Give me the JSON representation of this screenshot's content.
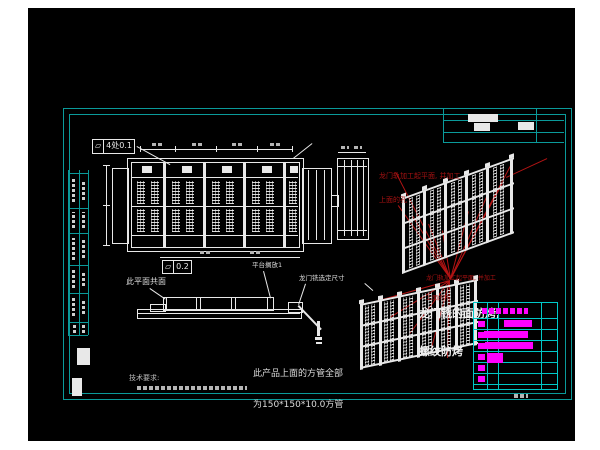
{
  "colors": {
    "white": "#e8e8e8",
    "gray": "#b5b5b5",
    "frame": "#0a9a9a",
    "table": "#00c8c8",
    "magenta": "#ff00ff",
    "red": "#b41414"
  },
  "annotations": {
    "fcf1_symbol": "▱",
    "fcf1_value": "4处0.1",
    "fcf2_symbol": "▱",
    "fcf2_value": "0.2",
    "coplanar_label": "此平面共面",
    "platform_label": "平台搁放1",
    "mill_dim_label": "龙门铣选定尺寸",
    "red_note_top_line1": "龙门轨加工起平面, 并加工",
    "red_note_top_line2": "上面的孔",
    "red_note_bottom_line1": "龙门轨加工起平面, 并加工",
    "red_note_bottom_line2": "上面的孔",
    "white_note_line1": "龙门铣的面防烤,",
    "white_note_line2": "螺纹防烤",
    "tube_note_line1": "此产品上面的方管全部",
    "tube_note_line2": "为150*150*10.0方管",
    "tech_req_title": "技术要求:"
  },
  "bom": {
    "box": [
      473,
      302,
      83,
      86
    ],
    "cols": [
      13,
      24,
      67
    ],
    "header_h": 15,
    "row_h": 11,
    "row_count": 6,
    "header_mask": [
      8,
      5,
      46,
      6
    ],
    "tag_blocks_y": [
      18,
      29,
      40,
      51,
      62,
      73
    ],
    "bars": [
      [
        30,
        17,
        28,
        7
      ],
      [
        10,
        28,
        44,
        7
      ],
      [
        11,
        39,
        48,
        7
      ],
      [
        13,
        50,
        16,
        10
      ]
    ]
  },
  "drawing": {
    "canvas": [
      28,
      8,
      547,
      433
    ],
    "frame_outer": [
      63,
      108,
      507,
      290
    ],
    "frame_inner": [
      69,
      114,
      495,
      278
    ],
    "left_strip": {
      "vlines": [
        [
          68,
          170,
          165
        ],
        [
          79,
          170,
          165
        ],
        [
          88,
          170,
          165
        ]
      ],
      "hlines": [
        [
          68,
          173,
          20
        ],
        [
          68,
          208,
          20
        ],
        [
          68,
          233,
          20
        ],
        [
          68,
          265,
          20
        ],
        [
          68,
          293,
          20
        ],
        [
          68,
          322,
          20
        ],
        [
          68,
          335,
          20
        ]
      ]
    },
    "corner": {
      "hlines": [
        [
          443,
          120,
          121
        ],
        [
          443,
          132,
          121
        ],
        [
          443,
          142,
          121
        ]
      ],
      "vlines": [
        [
          536,
          108,
          34
        ],
        [
          443,
          108,
          34
        ]
      ]
    },
    "fills": [
      [
        77,
        348,
        13,
        17
      ],
      [
        72,
        378,
        10,
        18
      ],
      [
        468,
        114,
        30,
        8
      ],
      [
        474,
        123,
        16,
        8
      ],
      [
        518,
        122,
        16,
        8
      ],
      [
        163,
        162,
        3,
        86
      ],
      [
        203,
        162,
        3,
        86
      ],
      [
        243,
        162,
        3,
        86
      ],
      [
        283,
        162,
        3,
        86
      ],
      [
        142,
        166,
        10,
        7
      ],
      [
        182,
        166,
        10,
        7
      ],
      [
        222,
        166,
        10,
        7
      ],
      [
        262,
        166,
        10,
        7
      ],
      [
        290,
        166,
        8,
        7
      ],
      [
        317,
        321,
        3,
        15
      ],
      [
        315,
        337,
        7,
        3
      ],
      [
        316,
        342,
        6,
        2
      ]
    ],
    "rects": [
      [
        127,
        158,
        175,
        92
      ],
      [
        131,
        162,
        167,
        84
      ],
      [
        112,
        168,
        15,
        74
      ],
      [
        302,
        168,
        28,
        74
      ],
      [
        337,
        158,
        30,
        80
      ],
      [
        331,
        195,
        6,
        10
      ],
      [
        137,
        309,
        163,
        8
      ],
      [
        150,
        304,
        14,
        6
      ],
      [
        163,
        297,
        109,
        12
      ],
      [
        288,
        302,
        13,
        9
      ]
    ],
    "hl_w": [
      [
        131,
        177,
        167
      ],
      [
        131,
        206,
        167
      ],
      [
        131,
        235,
        167
      ],
      [
        337,
        166,
        30
      ],
      [
        337,
        230,
        30
      ],
      [
        338,
        152,
        28
      ],
      [
        137,
        313,
        163
      ],
      [
        140,
        149,
        152
      ],
      [
        160,
        257,
        140
      ],
      [
        103,
        165,
        7
      ],
      [
        103,
        205,
        7
      ],
      [
        103,
        245,
        7
      ]
    ],
    "vl_w": [
      [
        344,
        160,
        76
      ],
      [
        351,
        160,
        76
      ],
      [
        357,
        160,
        76
      ],
      [
        363,
        160,
        76
      ],
      [
        308,
        170,
        70
      ],
      [
        316,
        170,
        70
      ],
      [
        324,
        170,
        70
      ],
      [
        166,
        297,
        12
      ],
      [
        196,
        297,
        12
      ],
      [
        200,
        297,
        12
      ],
      [
        231,
        297,
        12
      ],
      [
        235,
        297,
        12
      ],
      [
        267,
        297,
        12
      ],
      [
        106,
        165,
        80
      ],
      [
        140,
        146,
        6
      ],
      [
        175,
        146,
        6
      ],
      [
        216,
        146,
        6
      ],
      [
        257,
        146,
        6
      ],
      [
        292,
        146,
        6
      ]
    ],
    "dots_rows": {
      "y": [
        181,
        209
      ],
      "h": 23,
      "xs": [
        137,
        151,
        172,
        186,
        212,
        226,
        252,
        266,
        289
      ],
      "w": 8
    },
    "dg_w": [
      [
        137,
        146,
        170,
        164,
        1
      ],
      [
        293,
        158,
        312,
        143,
        1
      ],
      [
        150,
        288,
        166,
        299,
        1
      ],
      [
        264,
        271,
        271,
        298,
        1
      ],
      [
        306,
        284,
        299,
        305,
        1
      ],
      [
        299,
        305,
        322,
        329,
        2
      ],
      [
        365,
        283,
        373,
        290,
        1
      ]
    ],
    "dg_r": [
      [
        450,
        279,
        398,
        206,
        1
      ],
      [
        450,
        279,
        412,
        216,
        1
      ],
      [
        450,
        279,
        428,
        224,
        1
      ],
      [
        450,
        279,
        442,
        231,
        1
      ],
      [
        450,
        279,
        468,
        211,
        1
      ],
      [
        450,
        279,
        486,
        197,
        1
      ],
      [
        450,
        279,
        502,
        183,
        1
      ],
      [
        450,
        279,
        395,
        172,
        1
      ],
      [
        450,
        279,
        512,
        162,
        1
      ],
      [
        450,
        281,
        372,
        303,
        1
      ],
      [
        450,
        281,
        390,
        318,
        1
      ],
      [
        450,
        281,
        410,
        334,
        1
      ],
      [
        450,
        281,
        432,
        348,
        1
      ],
      [
        450,
        281,
        448,
        358,
        1
      ],
      [
        506,
        177,
        547,
        158,
        1
      ]
    ],
    "masks_h": [
      [
        152,
        143,
        10,
        3
      ],
      [
        192,
        143,
        10,
        3
      ],
      [
        232,
        143,
        10,
        3
      ],
      [
        270,
        143,
        10,
        3
      ],
      [
        341,
        146,
        8,
        3
      ],
      [
        354,
        146,
        8,
        3
      ],
      [
        200,
        251,
        12,
        3
      ],
      [
        250,
        251,
        12,
        3
      ],
      [
        514,
        394,
        14,
        4
      ],
      [
        137,
        386,
        110,
        4
      ]
    ],
    "masks_v": [
      [
        72,
        178,
        3,
        24
      ],
      [
        82,
        180,
        3,
        20
      ],
      [
        72,
        212,
        3,
        16
      ],
      [
        82,
        212,
        3,
        16
      ],
      [
        72,
        238,
        3,
        22
      ],
      [
        82,
        240,
        3,
        18
      ],
      [
        72,
        270,
        3,
        18
      ],
      [
        82,
        272,
        3,
        14
      ],
      [
        72,
        298,
        3,
        18
      ],
      [
        82,
        300,
        3,
        14
      ],
      [
        73,
        325,
        3,
        8
      ],
      [
        82,
        325,
        3,
        8
      ]
    ],
    "iso": [
      {
        "x": 402,
        "y": 198,
        "w": 112,
        "h": 76,
        "skew": -20,
        "posts": [
          0,
          21,
          42,
          63,
          84,
          108
        ],
        "postw": 3,
        "rails": [
          0,
          25,
          50,
          74
        ],
        "strips": [
          7,
          14,
          28,
          35,
          49,
          56,
          70,
          77,
          91,
          98
        ],
        "stripw": 4
      },
      {
        "x": 360,
        "y": 304,
        "w": 118,
        "h": 66,
        "skew": -12,
        "posts": [
          0,
          19,
          38,
          57,
          76,
          95,
          114
        ],
        "postw": 3,
        "rails": [
          0,
          21,
          42,
          63
        ],
        "strips": [
          5,
          11,
          24,
          30,
          43,
          49,
          62,
          68,
          81,
          87,
          100,
          106
        ],
        "stripw": 4
      }
    ]
  }
}
